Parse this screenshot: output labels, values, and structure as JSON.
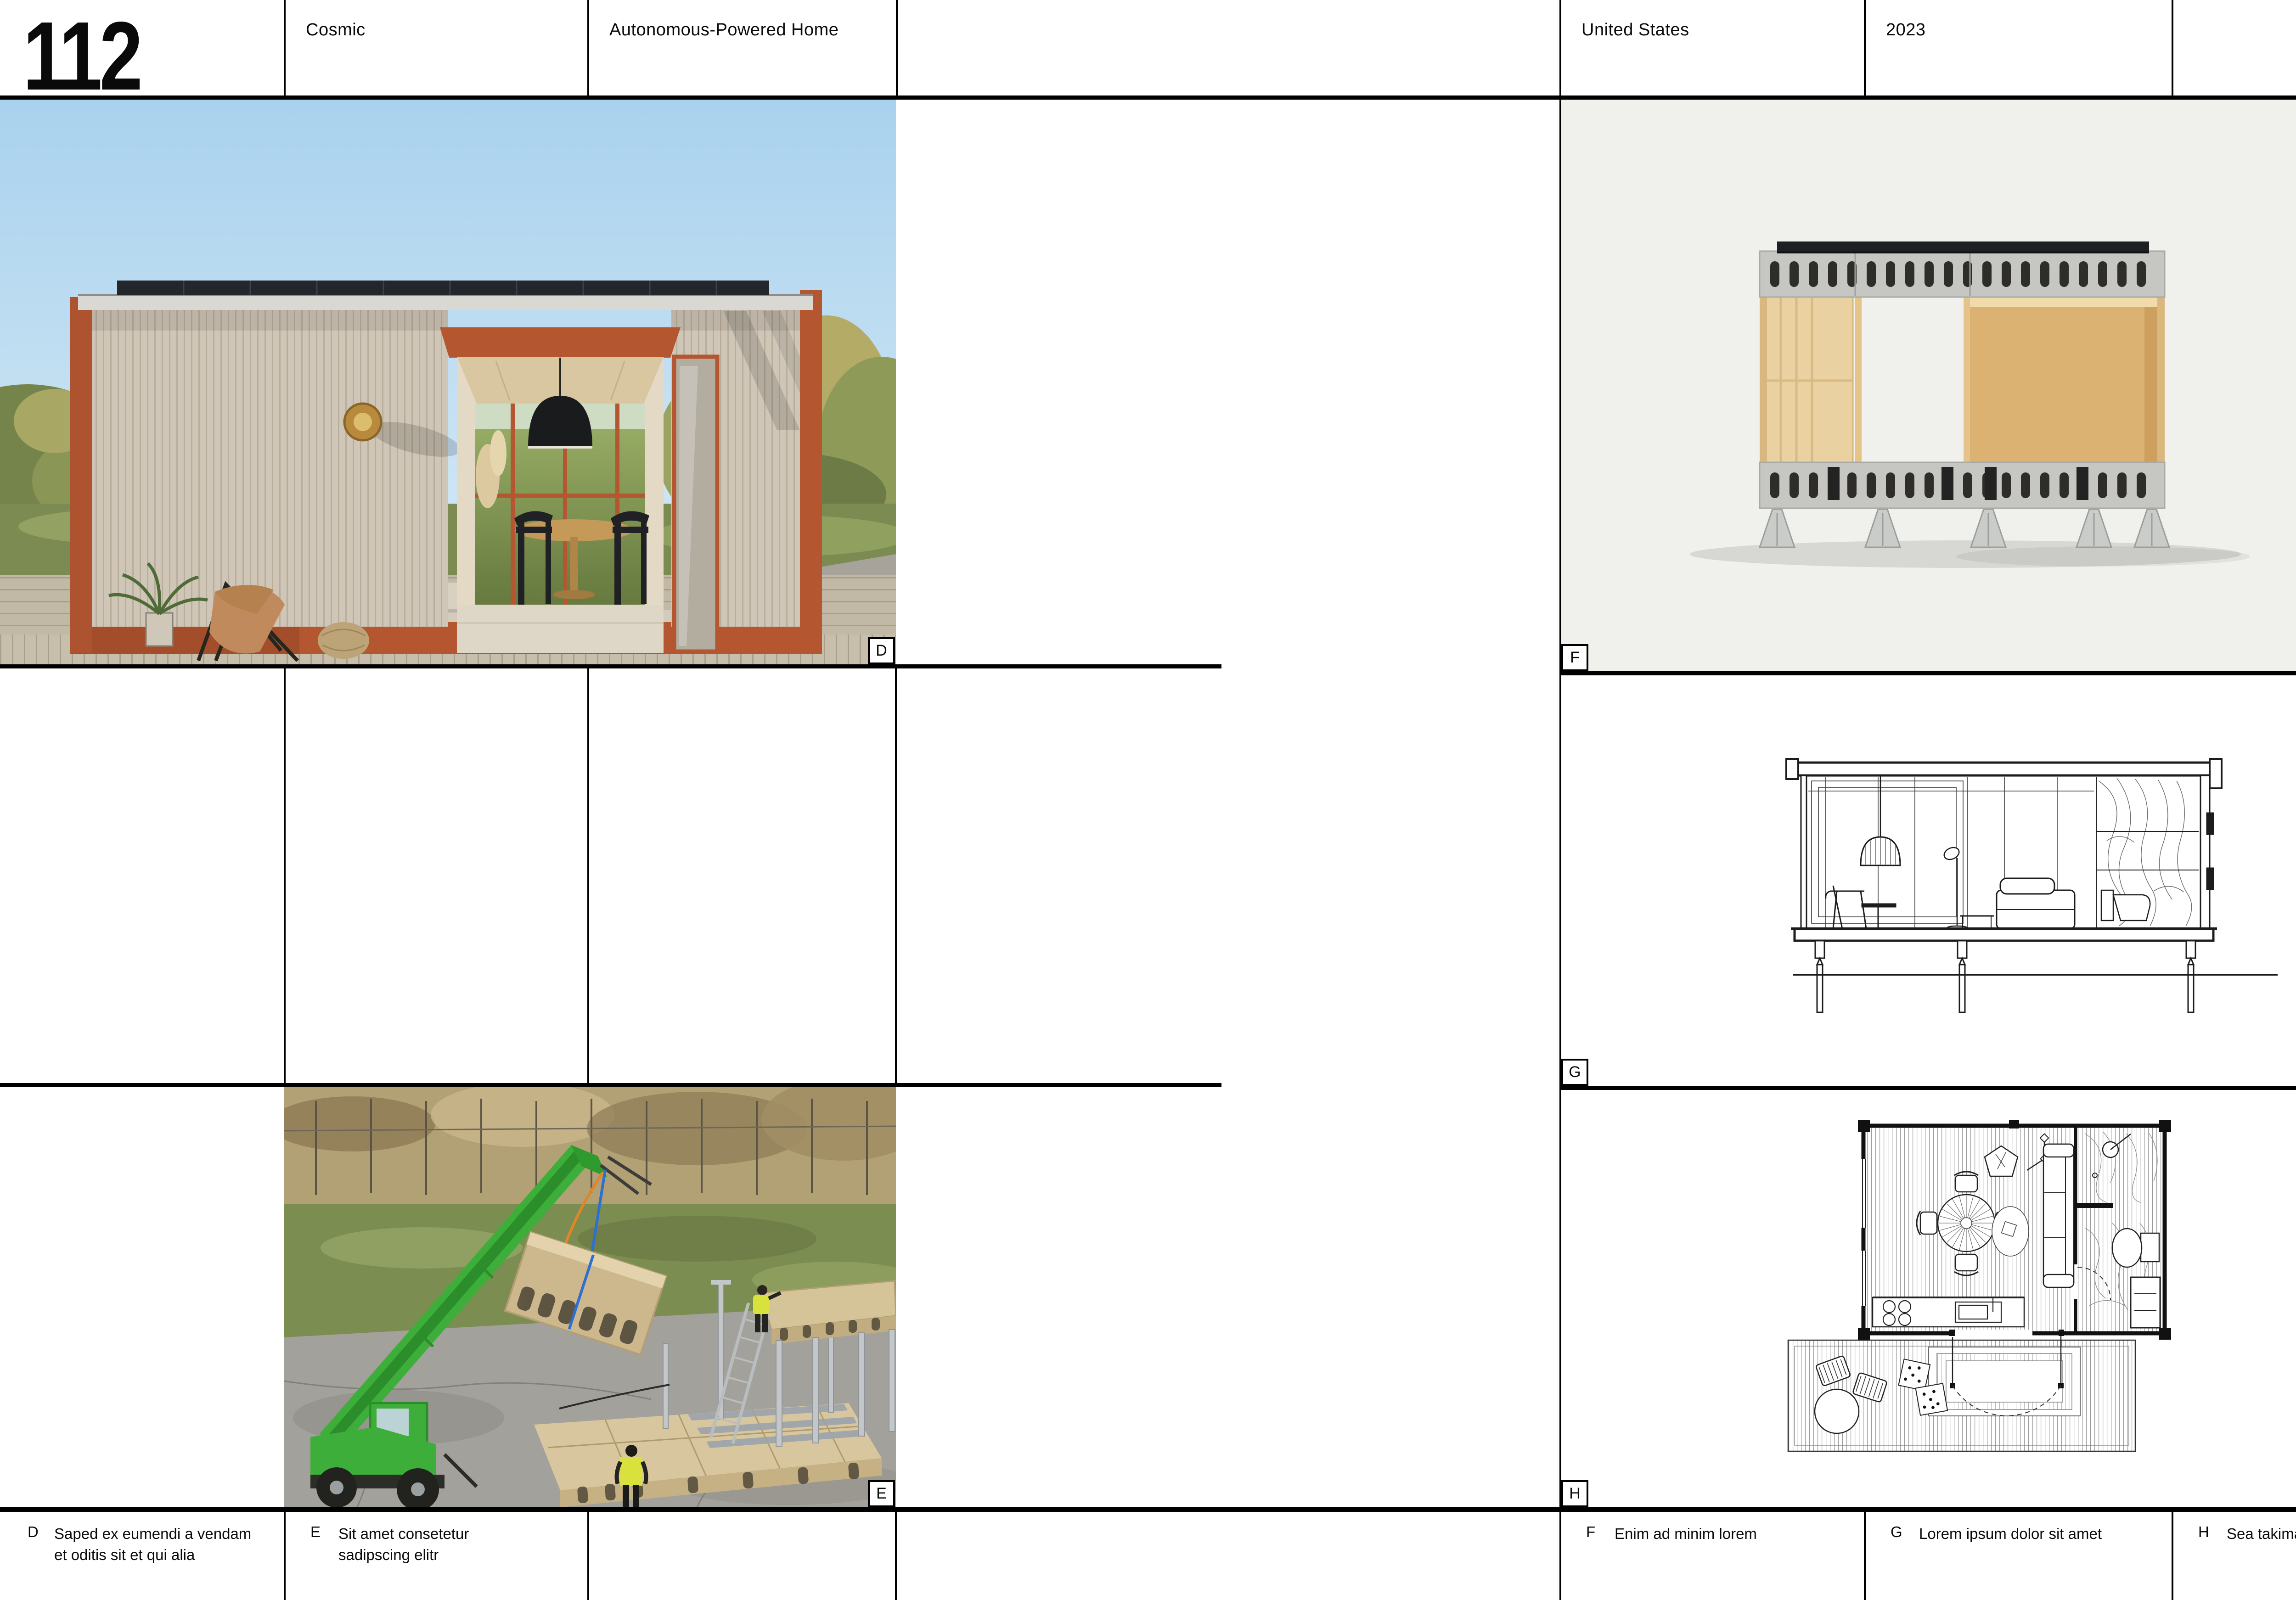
{
  "header": {
    "left_page_number": "112",
    "project_title": "Cosmic",
    "project_subtitle": "Autonomous-Powered Home",
    "country": "United States",
    "year": "2023",
    "right_page_number": "113"
  },
  "figures": {
    "d": {
      "label": "D",
      "lines": [
        "Saped ex eumendi a vendam",
        "et oditis sit et qui alia"
      ]
    },
    "e": {
      "label": "E",
      "lines": [
        "Sit amet consetetur",
        "sadipscing elitr"
      ]
    },
    "f": {
      "label": "F",
      "lines": [
        "Enim ad minim lorem"
      ]
    },
    "g": {
      "label": "G",
      "lines": [
        "Lorem ipsum dolor sit amet"
      ]
    },
    "h": {
      "label": "H",
      "lines": [
        "Sea takimata sanctus"
      ]
    }
  },
  "colors": {
    "rule_black": "#000000",
    "accent_rust": "#b4562f",
    "render_background": "#f0f0ec",
    "machine_green": "#3dae39",
    "hivis_yellow": "#d9e23c"
  }
}
